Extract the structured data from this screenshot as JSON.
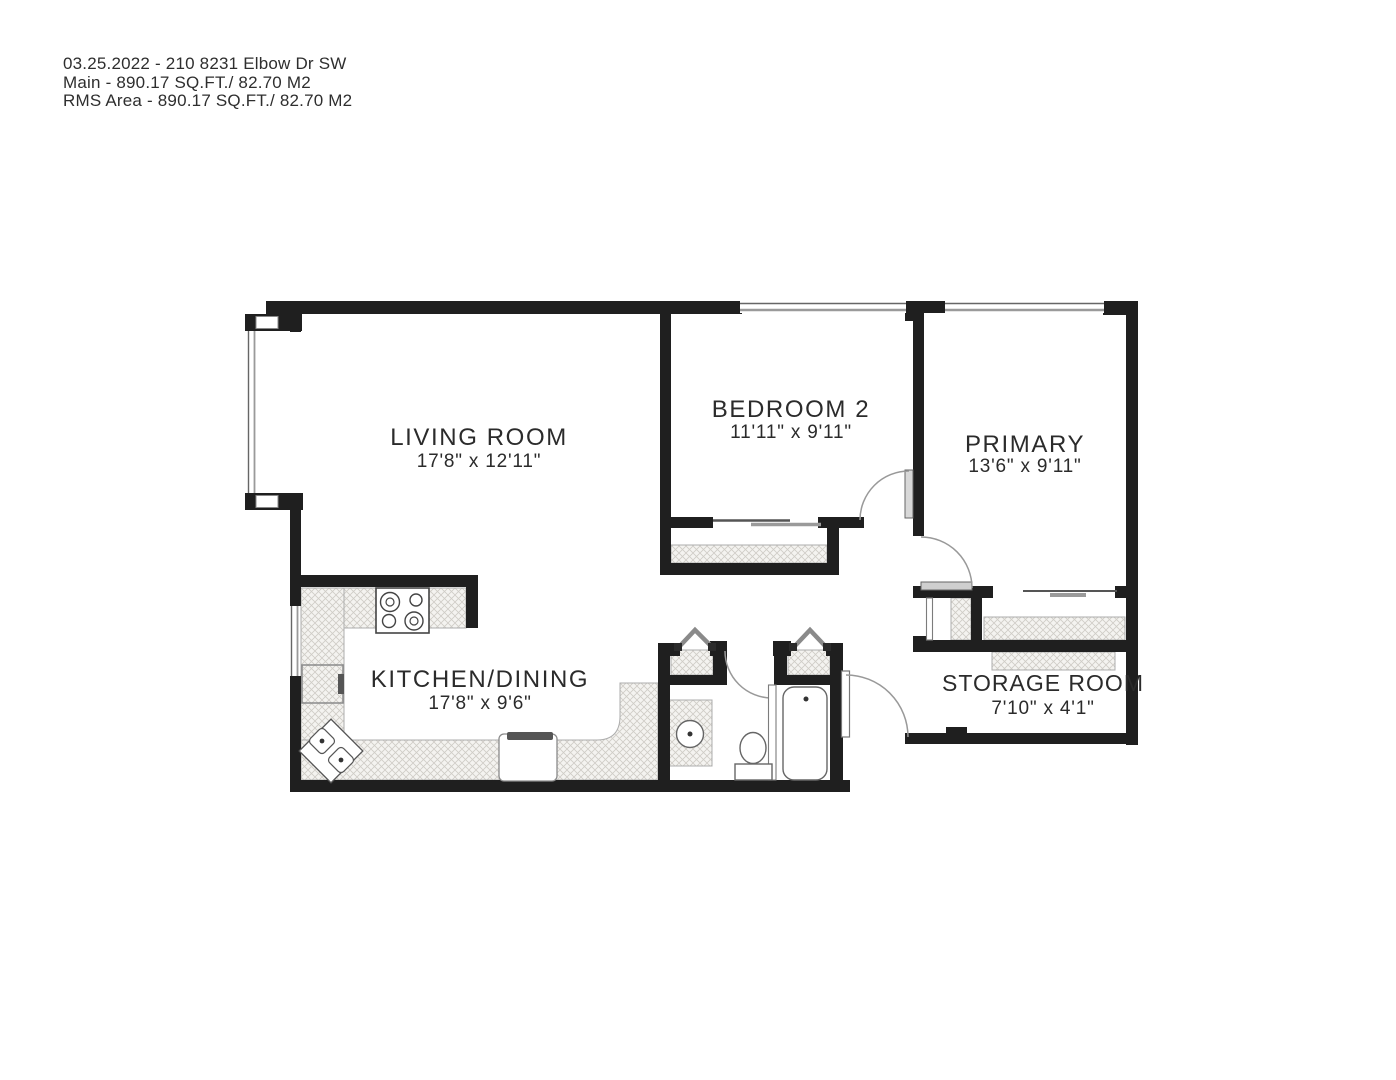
{
  "header": {
    "line1": "03.25.2022 - 210 8231 Elbow Dr SW",
    "line2": "Main - 890.17 SQ.FT./ 82.70 M2",
    "line3": "RMS Area - 890.17 SQ.FT./ 82.70 M2"
  },
  "rooms": {
    "living_room": {
      "name": "LIVING ROOM",
      "dims": "17'8\" x 12'11\""
    },
    "bedroom_2": {
      "name": "BEDROOM 2",
      "dims": "11'11\" x 9'11\""
    },
    "primary": {
      "name": "PRIMARY",
      "dims": "13'6\" x 9'11\""
    },
    "kitchen_dining": {
      "name": "KITCHEN/DINING",
      "dims": "17'8\" x 9'6\""
    },
    "storage_room": {
      "name": "STORAGE ROOM",
      "dims": "7'10\" x 4'1\""
    }
  },
  "colors": {
    "background": "#ffffff",
    "wall": "#1f1f1f",
    "thin_line": "#8a8a8a",
    "hatch_fill": "#f4f3f0",
    "hatch_line": "#cfccc6",
    "text": "#2b2b2b"
  },
  "fixtures": [
    "stove",
    "kitchen-corner-sink",
    "counter-appliance",
    "dishwasher",
    "bathroom-vanity-sink",
    "toilet",
    "bathtub",
    "bifold-closet-doors",
    "sliding-closet-doors",
    "hinged-doors",
    "windows"
  ]
}
